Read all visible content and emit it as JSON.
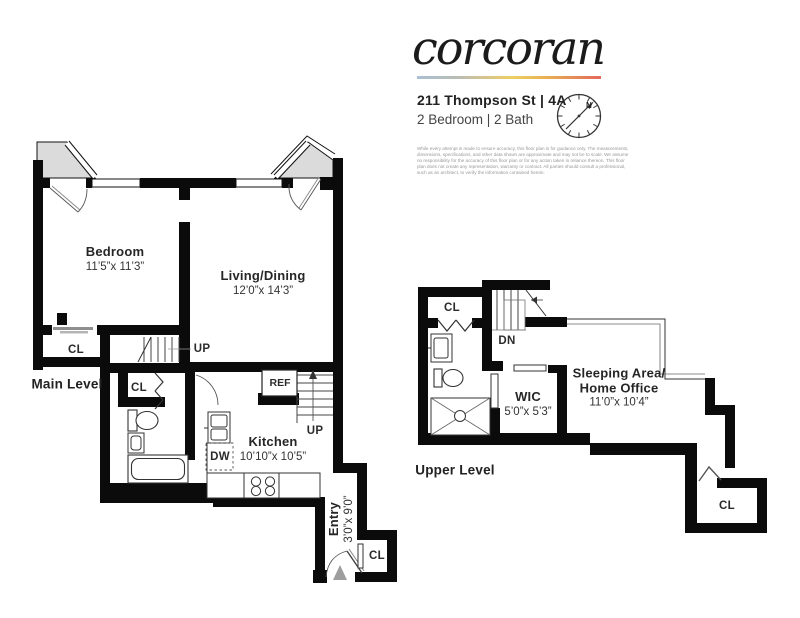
{
  "header": {
    "logo": "corcoran",
    "address": "211 Thompson St | 4A",
    "subtitle": "2 Bedroom | 2 Bath",
    "disclaimer": "While every attempt is made to ensure accuracy, this floor plan is for guidance only. The measurements, dimensions, specifications, and other data shown are approximate and may not be to scale. We assume no responsibility for the accuracy of this floor plan or for any action taken in reliance thereon. This floor plan does not create any representation, warranty or contract. All parties should consult a professional, such as an architect, to verify the information contained herein.",
    "brand_gradient": [
      "#a9bfd3",
      "#eccf63",
      "#e2695a"
    ]
  },
  "compass": {
    "north_label": "N"
  },
  "main_level": {
    "title": "Main Level",
    "bedroom_name": "Bedroom",
    "bedroom_dims": "11’5”x 11’3”",
    "living_name": "Living/Dining",
    "living_dims": "12’0”x 14’3”",
    "kitchen_name": "Kitchen",
    "kitchen_dims": "10’10”x 10’5”",
    "entry_name": "Entry",
    "entry_dims": "3’0”x 9’0”",
    "closet_bedroom": "CL",
    "closet_hall": "CL",
    "closet_entry": "CL",
    "stairs_up_hall": "UP",
    "stairs_up_kitchen": "UP",
    "refrigerator": "REF",
    "dishwasher": "DW"
  },
  "upper_level": {
    "title": "Upper Level",
    "wic_name": "WIC",
    "wic_dims": "5’0”x 5’3”",
    "sleeping_name_line1": "Sleeping Area/",
    "sleeping_name_line2": "Home Office",
    "sleeping_dims": "11’0”x 10’4”",
    "closet_top": "CL",
    "closet_right": "CL",
    "stairs_down": "DN"
  }
}
